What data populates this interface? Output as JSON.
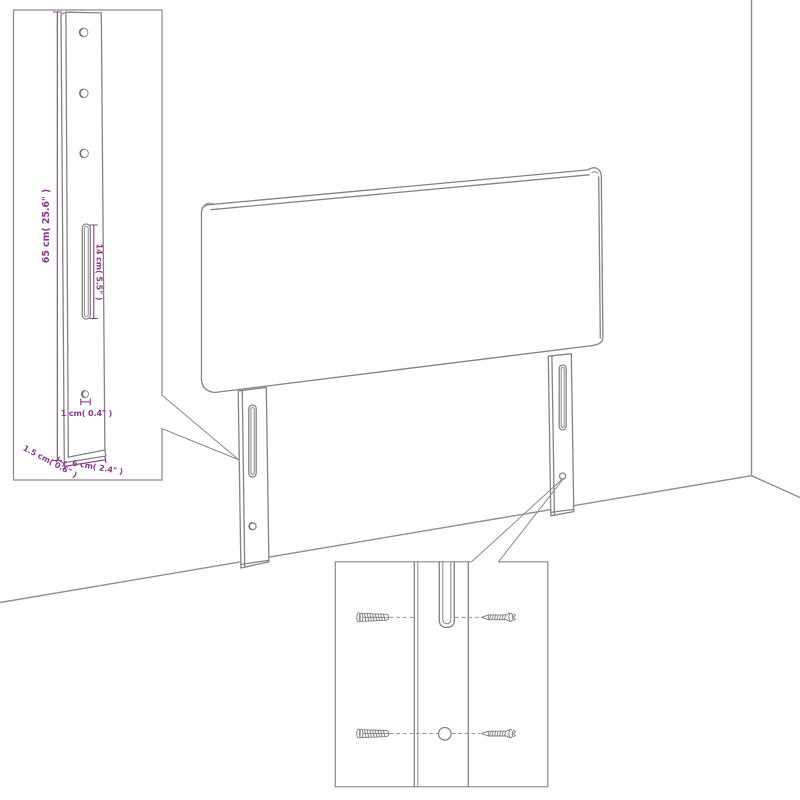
{
  "annotations": {
    "height_label": "65 cm( 25.6\" )",
    "slot_label": "14 cm( 5.5\" )",
    "hole_label": "1 cm( 0.4\" )",
    "thickness_label": "1.5 cm( 0.6\" )",
    "width_label": "6 cm( 2.4\" )"
  },
  "colors": {
    "drawing_line": "#838383",
    "dimension_accent": "#8a3a8a",
    "background": "#ffffff"
  }
}
